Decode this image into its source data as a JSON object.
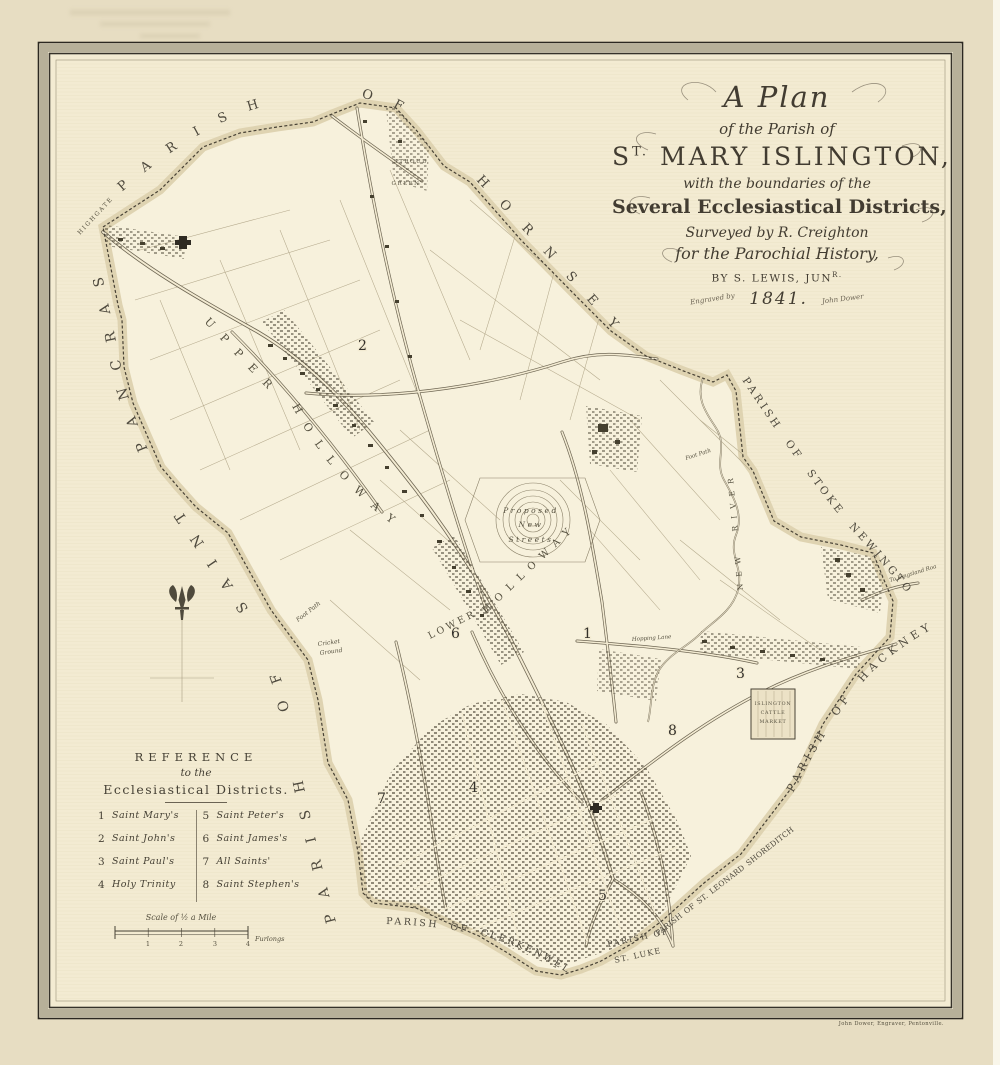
{
  "title": {
    "line1": "A Plan",
    "line2": "of the Parish of",
    "line3_initial": "S",
    "line3_sup": "T.",
    "line3_rest": "MARY ISLINGTON,",
    "line4": "with the boundaries of the",
    "line5": "Several Ecclesiastical Districts,",
    "line6": "Surveyed by R. Creighton",
    "line7": "for the Parochial History,",
    "line8_pre": "BY S. LEWIS, JUN",
    "line8_sup": "R.",
    "engraved": "Engraved by",
    "year": "1841.",
    "engraver": "John Dower"
  },
  "boundaries": {
    "pancras": "PARISH OF SAINT PANCRAS",
    "hornsey": "PARISH OF HORNSEY",
    "stoke": "PARISH OF STOKE NEWINGTON",
    "hackney": "PARISH OF HACKNEY",
    "clerkenwell": "PARISH OF CLERKENWELL",
    "stluke_1": "PARISH OF",
    "stluke_2": "ST. LUKE",
    "shoreditch": "PARISH OF ST. LEONARD SHOREDITCH"
  },
  "places": {
    "highgate": "HIGHGATE",
    "stroud": "STROUD",
    "green": "GREEN",
    "upper": "UPPER",
    "holloway_1": "HOLLOWAY",
    "holloway_2": "HOLLOWAY",
    "lower": "LOWER",
    "proposed": "Proposed",
    "new": "New",
    "streets": "Streets",
    "new_river": "NEW RIVER",
    "islington": "ISLINGTON",
    "cattle": "CATTLE",
    "market": "MARKET",
    "cricket_1": "Cricket",
    "cricket_2": "Ground",
    "foot_path_1": "Foot Path",
    "foot_path_2": "Foot Path",
    "hopping": "Hopping Lane",
    "kingsland": "To Kingsland Road"
  },
  "districts": [
    "1",
    "2",
    "3",
    "4",
    "5",
    "6",
    "7",
    "8"
  ],
  "reference": {
    "title": "REFERENCE",
    "subtitle": "to the",
    "heading": "Ecclesiastical Districts.",
    "items": [
      {
        "num": "1",
        "name": "Saint Mary's"
      },
      {
        "num": "2",
        "name": "Saint John's"
      },
      {
        "num": "3",
        "name": "Saint Paul's"
      },
      {
        "num": "4",
        "name": "Holy Trinity"
      },
      {
        "num": "5",
        "name": "Saint Peter's"
      },
      {
        "num": "6",
        "name": "Saint James's"
      },
      {
        "num": "7",
        "name": "All Saints'"
      },
      {
        "num": "8",
        "name": "Saint Stephen's"
      }
    ]
  },
  "scale": {
    "title": "Scale of ½ a Mile",
    "t1": "1",
    "t2": "2",
    "t3": "3",
    "t4": "4",
    "unit": "Furlongs"
  },
  "imprint": "John Dower, Engraver, Pentonville."
}
